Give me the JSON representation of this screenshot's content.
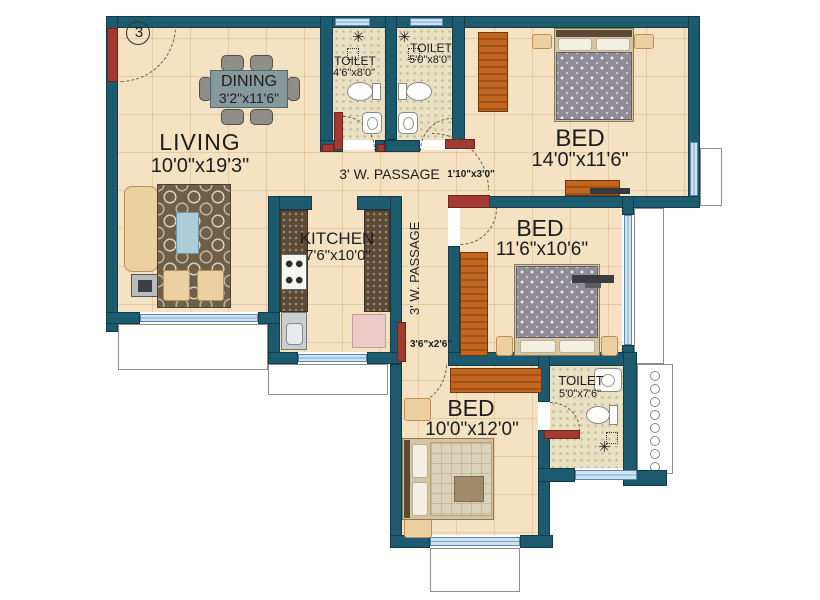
{
  "plan": {
    "unit_number": "3",
    "rooms": {
      "living": {
        "name": "LIVING",
        "dims": "10'0\"x19'3\""
      },
      "dining": {
        "name": "DINING",
        "dims": "3'2\"x11'6\""
      },
      "toilet_tl": {
        "name": "TOILET",
        "dims": "4'6\"x8'0\""
      },
      "toilet_tr": {
        "name": "TOILET",
        "dims": "5'0\"x8'0\""
      },
      "bed_tr": {
        "name": "BED",
        "dims": "14'0\"x11'6\""
      },
      "bed_mr": {
        "name": "BED",
        "dims": "11'6\"x10'6\""
      },
      "bed_b": {
        "name": "BED",
        "dims": "10'0\"x12'0\""
      },
      "kitchen": {
        "name": "KITCHEN",
        "dims": "7'6\"x10'0\""
      },
      "toilet_b": {
        "name": "TOILET",
        "dims": "5'0\"x7'6\""
      },
      "passage_h": {
        "name": "3' W. PASSAGE",
        "dims": "1'10\"x3'0\""
      },
      "passage_v": {
        "name": "3' W. PASSAGE",
        "dims": "3'6\"x2'6\""
      }
    },
    "icons": {
      "shower": "✳"
    },
    "colors": {
      "wall": "#1c5a70",
      "window": "#cfe4f3",
      "door_leaf": "#a23a31",
      "floor": "#f4e2c2",
      "toilet_floor": "#e9e1c3",
      "wood_furniture": "#c2661f",
      "sofa_cream": "#ecd0a0",
      "duvet_gray": "#8f8c95"
    }
  }
}
